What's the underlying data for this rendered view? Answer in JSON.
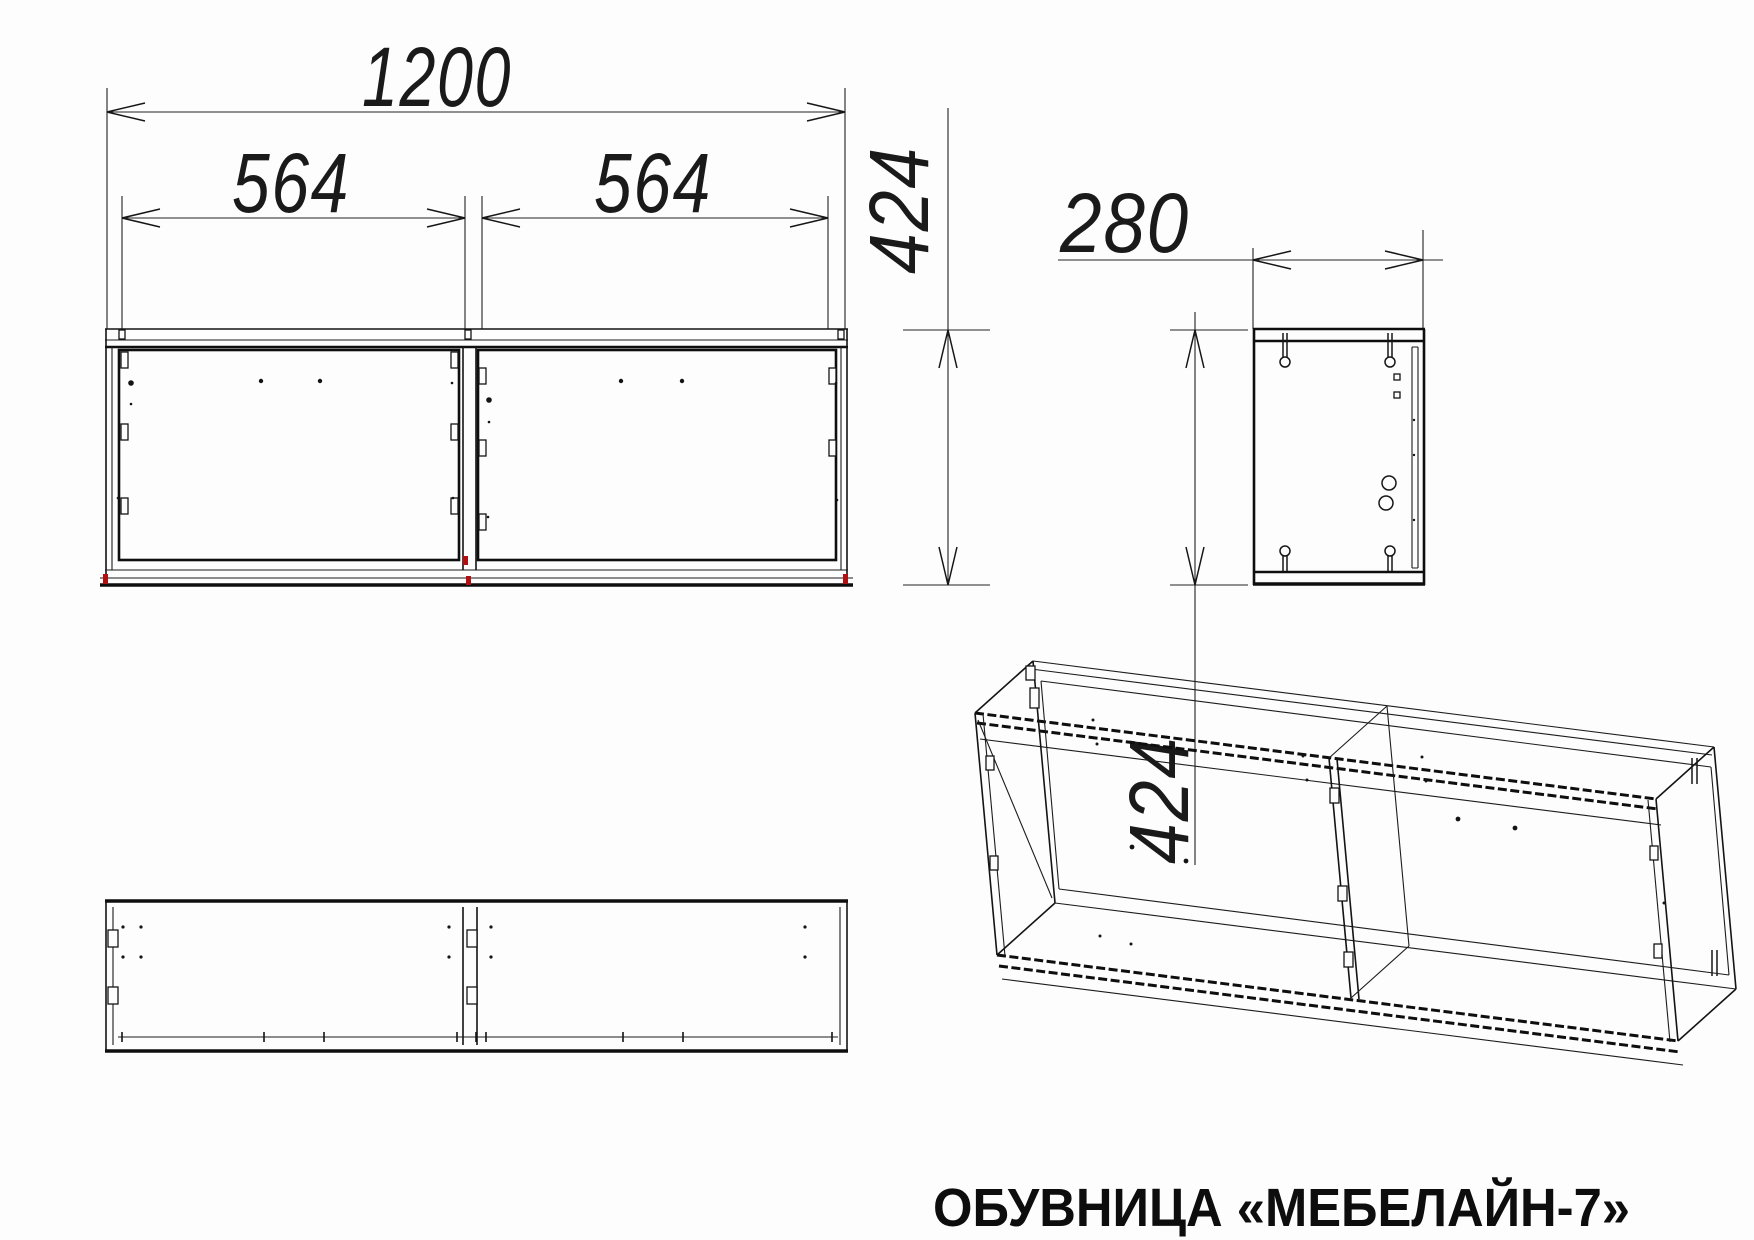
{
  "title": "ОБУВНИЦА «МЕБЕЛАЙН-7»",
  "product_type": "shoe cabinet technical drawing",
  "colors": {
    "line": "#141414",
    "accent_red": "#b01010",
    "background": "#fdfdfd"
  },
  "dims": {
    "total_width": "1200",
    "left_door": "564",
    "right_door": "564",
    "front_height": "424",
    "depth": "280",
    "side_height": "424"
  }
}
